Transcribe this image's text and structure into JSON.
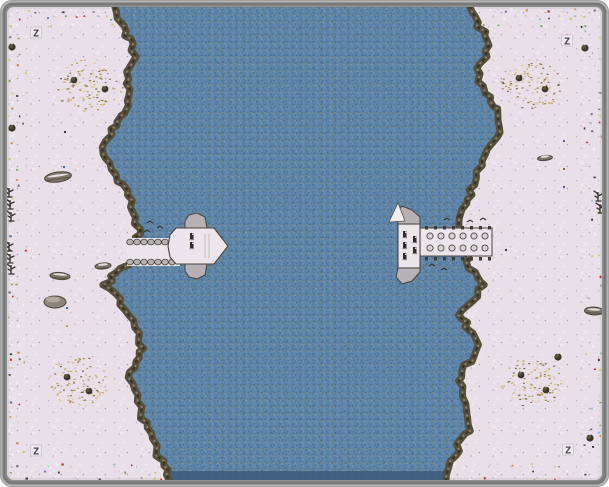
{
  "map": {
    "width": 609,
    "height": 487,
    "seed": 1337,
    "colors": {
      "frame": "#8e8e8e",
      "frameLight": "#b4b4b4",
      "frameDark": "#6a6a6a",
      "snow": "#e9dfe8",
      "waterBase": "#5d83a9",
      "waterPix": [
        "#4b739b",
        "#6688aa",
        "#6f92b5",
        "#7e9ec0",
        "#53809e",
        "#7b8a78",
        "#4a6f94",
        "#86a3c2",
        "#456b8f"
      ],
      "waterPixDark": [
        "#3e638a",
        "#52707f",
        "#476a8e"
      ],
      "coast": "#564f3b",
      "coastDark": "#3a3426",
      "coastLight": "#8d8570",
      "coastSnow": "#ece5ea",
      "deck": "#ece6ec",
      "deckEdge": "#4a443c",
      "stone": "#b7b0b4",
      "barrel": "#d8d2d6",
      "barrelEdge": "#4f4a44",
      "cleat": "#2f2b26",
      "bottomBand": "#3c5878",
      "treeDark": "#3a362a",
      "treeLight": "#5e5840",
      "logBody": "#7f766a",
      "logEdge": "#4d473c",
      "rockBody": "#8d857b",
      "rockLight": "#b5aca1",
      "markerInk": "#4e4954",
      "markerBg": "#efeaef",
      "snowDots": [
        "#f7f1f6",
        "#f7f1f6",
        "#dcd0da",
        "#dcd0da",
        "#cfc3cf",
        "#bfb3bf",
        "#a89cab"
      ],
      "grovePalette": [
        "#c9ae5f",
        "#ac924c",
        "#8d783d",
        "#dbc67e",
        "#6c6233",
        "#b4a05a"
      ],
      "dotPalette": [
        [
          "#f4f2f2",
          3
        ],
        [
          "#d9d2cc",
          2
        ],
        [
          "#b23527",
          1
        ],
        [
          "#77a763",
          1
        ],
        [
          "#ccc87b",
          1
        ],
        [
          "#8fc0bd",
          0.6
        ],
        [
          "#5a77a6",
          0.5
        ],
        [
          "#c28a4a",
          0.6
        ],
        [
          "#6f6f6f",
          1
        ],
        [
          "#3f3d35",
          0.7
        ]
      ]
    },
    "coastLeft": [
      [
        112,
        7
      ],
      [
        122,
        25
      ],
      [
        131,
        45
      ],
      [
        134,
        62
      ],
      [
        127,
        78
      ],
      [
        131,
        95
      ],
      [
        123,
        112
      ],
      [
        112,
        130
      ],
      [
        103,
        148
      ],
      [
        111,
        164
      ],
      [
        119,
        180
      ],
      [
        128,
        196
      ],
      [
        134,
        212
      ],
      [
        139,
        228
      ],
      [
        137,
        244
      ],
      [
        133,
        260
      ],
      [
        117,
        272
      ],
      [
        106,
        284
      ],
      [
        118,
        300
      ],
      [
        129,
        315
      ],
      [
        139,
        332
      ],
      [
        142,
        348
      ],
      [
        134,
        362
      ],
      [
        129,
        378
      ],
      [
        137,
        395
      ],
      [
        141,
        412
      ],
      [
        147,
        428
      ],
      [
        154,
        444
      ],
      [
        161,
        460
      ],
      [
        169,
        480
      ]
    ],
    "coastRight": [
      [
        468,
        7
      ],
      [
        477,
        22
      ],
      [
        488,
        40
      ],
      [
        484,
        58
      ],
      [
        478,
        75
      ],
      [
        487,
        92
      ],
      [
        498,
        110
      ],
      [
        501,
        126
      ],
      [
        492,
        143
      ],
      [
        484,
        160
      ],
      [
        476,
        178
      ],
      [
        469,
        194
      ],
      [
        464,
        210
      ],
      [
        461,
        226
      ],
      [
        463,
        242
      ],
      [
        467,
        258
      ],
      [
        473,
        272
      ],
      [
        483,
        286
      ],
      [
        473,
        300
      ],
      [
        459,
        314
      ],
      [
        468,
        328
      ],
      [
        478,
        344
      ],
      [
        471,
        360
      ],
      [
        459,
        376
      ],
      [
        463,
        392
      ],
      [
        469,
        408
      ],
      [
        471,
        424
      ],
      [
        461,
        440
      ],
      [
        454,
        456
      ],
      [
        446,
        480
      ]
    ],
    "bands": [
      {
        "x": 8,
        "y": 8,
        "w": 18,
        "h": 471
      },
      {
        "x": 583,
        "y": 8,
        "w": 18,
        "h": 471
      },
      {
        "x": 26,
        "y": 8,
        "w": 86,
        "h": 16
      },
      {
        "x": 468,
        "y": 8,
        "w": 115,
        "h": 16
      },
      {
        "x": 26,
        "y": 463,
        "w": 142,
        "h": 16
      },
      {
        "x": 446,
        "y": 463,
        "w": 137,
        "h": 16
      }
    ],
    "seams": [
      {
        "x1": 302,
        "y1": 8,
        "x2": 302,
        "y2": 128
      },
      {
        "x1": 380,
        "y1": 160,
        "x2": 380,
        "y2": 262
      }
    ],
    "piers": {
      "left": {
        "walkway": {
          "x": 127,
          "y": 238,
          "w": 53,
          "h": 28
        },
        "bumpRows": [
          242,
          262
        ],
        "bumpX": [
          130,
          177
        ],
        "platform": [
          [
            176,
            228
          ],
          [
            214,
            228
          ],
          [
            228,
            246
          ],
          [
            214,
            264
          ],
          [
            176,
            264
          ],
          [
            170,
            257
          ],
          [
            168,
            246
          ],
          [
            170,
            235
          ]
        ],
        "capTop": [
          [
            185,
            228
          ],
          [
            185,
            221
          ],
          [
            189,
            215
          ],
          [
            197,
            213
          ],
          [
            205,
            217
          ],
          [
            207,
            228
          ]
        ],
        "capBottom": [
          [
            185,
            264
          ],
          [
            185,
            271
          ],
          [
            189,
            277
          ],
          [
            197,
            279
          ],
          [
            205,
            275
          ],
          [
            207,
            264
          ]
        ],
        "cleats": [
          [
            190,
            233
          ],
          [
            190,
            242
          ]
        ],
        "rails": [
          [
            205,
            234,
            205,
            258
          ],
          [
            209,
            234,
            209,
            258
          ]
        ],
        "birds": [
          [
            150,
            222
          ],
          [
            160,
            227
          ],
          [
            147,
            231
          ]
        ]
      },
      "right": {
        "platform": {
          "x": 398,
          "y": 224,
          "w": 22,
          "h": 44
        },
        "capTop": [
          [
            398,
            224
          ],
          [
            396,
            213
          ],
          [
            402,
            206
          ],
          [
            412,
            210
          ],
          [
            420,
            217
          ],
          [
            420,
            224
          ]
        ],
        "sail": [
          [
            389,
            222
          ],
          [
            398,
            203
          ],
          [
            405,
            221
          ]
        ],
        "capBottom": [
          [
            398,
            268
          ],
          [
            396,
            277
          ],
          [
            402,
            284
          ],
          [
            412,
            281
          ],
          [
            420,
            272
          ],
          [
            420,
            268
          ]
        ],
        "walkway": {
          "x": 420,
          "y": 228,
          "w": 72,
          "h": 28
        },
        "postRows": [
          226,
          257
        ],
        "postX": [
          425,
          491
        ],
        "barrelRows": [
          236,
          248
        ],
        "barrelX0": 430,
        "barrelDx": 11,
        "barrelN": 6,
        "cleats": [
          [
            403,
            231
          ],
          [
            403,
            242
          ],
          [
            403,
            253
          ],
          [
            413,
            236
          ],
          [
            413,
            247
          ]
        ],
        "birds": [
          [
            447,
            219
          ],
          [
            459,
            217
          ],
          [
            470,
            221
          ],
          [
            483,
            219
          ],
          [
            432,
            265
          ],
          [
            444,
            269
          ]
        ]
      }
    },
    "groves": [
      {
        "cx": 88,
        "cy": 85,
        "rx": 34,
        "ry": 26,
        "trees": [
          [
            74,
            80
          ],
          [
            105,
            89
          ]
        ]
      },
      {
        "cx": 530,
        "cy": 84,
        "rx": 32,
        "ry": 25,
        "trees": [
          [
            519,
            78
          ],
          [
            545,
            89
          ]
        ]
      },
      {
        "cx": 78,
        "cy": 381,
        "rx": 30,
        "ry": 25,
        "trees": [
          [
            67,
            377
          ],
          [
            89,
            391
          ]
        ]
      },
      {
        "cx": 531,
        "cy": 381,
        "rx": 31,
        "ry": 25,
        "trees": [
          [
            521,
            375
          ],
          [
            546,
            390
          ]
        ]
      }
    ],
    "snags": [
      [
        9,
        197
      ],
      [
        10,
        209
      ],
      [
        11,
        221
      ],
      [
        9,
        251
      ],
      [
        10,
        263
      ],
      [
        11,
        274
      ],
      [
        598,
        201
      ],
      [
        600,
        213
      ]
    ],
    "logs": [
      {
        "x": 58,
        "y": 177,
        "w": 27,
        "h": 10,
        "rot": -8
      },
      {
        "x": 60,
        "y": 276,
        "w": 20,
        "h": 7,
        "rot": 4
      },
      {
        "x": 103,
        "y": 266,
        "w": 16,
        "h": 6,
        "rot": -5
      },
      {
        "x": 545,
        "y": 158,
        "w": 15,
        "h": 5,
        "rot": -6
      },
      {
        "x": 594,
        "y": 311,
        "w": 19,
        "h": 8,
        "rot": 3
      }
    ],
    "rocks": [
      {
        "x": 55,
        "y": 302,
        "w": 22,
        "h": 12
      }
    ],
    "bushes": [
      [
        12,
        47
      ],
      [
        12,
        128
      ],
      [
        585,
        48
      ],
      [
        590,
        438
      ],
      [
        558,
        357
      ]
    ],
    "specks": [
      {
        "x": 63,
        "y": 166,
        "c": "#4a66a8"
      },
      {
        "x": 563,
        "y": 140,
        "c": "#4a66a8"
      },
      {
        "x": 563,
        "y": 186,
        "c": "#4a66a8"
      },
      {
        "x": 66,
        "y": 307,
        "c": "#4a66a8"
      },
      {
        "x": 66,
        "y": 325,
        "c": "#b5a435"
      },
      {
        "x": 563,
        "y": 168,
        "c": "#8a6a35"
      },
      {
        "x": 64,
        "y": 131,
        "c": "#3f3b33"
      },
      {
        "x": 505,
        "y": 249,
        "c": "#3f3b33"
      }
    ],
    "markers": {
      "glyph": "Z",
      "positions": [
        [
          36,
          33
        ],
        [
          567,
          41
        ],
        [
          36,
          451
        ],
        [
          568,
          450
        ]
      ]
    }
  }
}
